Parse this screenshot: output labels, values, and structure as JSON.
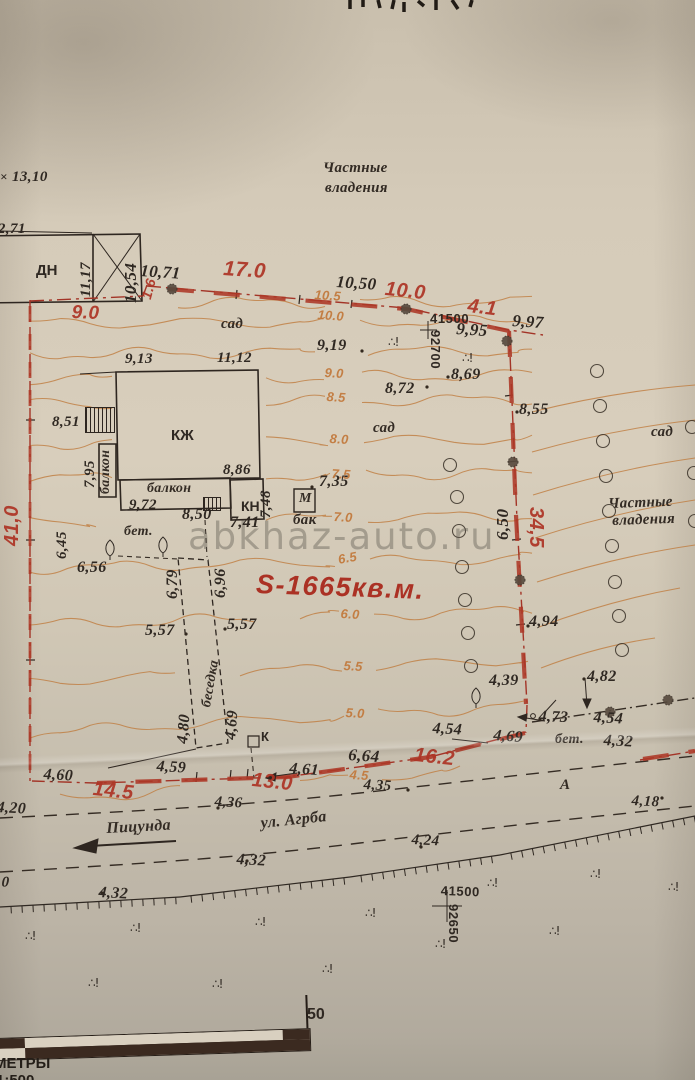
{
  "colors": {
    "paper": "#d5cbb9",
    "ink": "#2f2822",
    "red_boundary": "#a83526",
    "red_label": "#ae3526",
    "contour_orange": "#c07c3e",
    "watermark_gray": "#605a52",
    "scalebar_dark": "#3b2a20"
  },
  "watermark": "abkhaz-auto.ru",
  "plot": {
    "area_label": "S-1665кв.м."
  },
  "scale": {
    "bar_max": "50",
    "units": "МЕТРЫ",
    "ratio": "1:500"
  },
  "street": {
    "name": "ул. Агрба",
    "direction": "Пицунда",
    "section_point": "А"
  },
  "grid_crosses": [
    {
      "x_label": "41500",
      "y_label": "92700"
    },
    {
      "x_label": "41500",
      "y_label": "92650"
    }
  ],
  "labels": [
    {
      "t": "×",
      "x": 0,
      "y": 170,
      "c": "e",
      "s": 13
    },
    {
      "t": "13,10",
      "x": 12,
      "y": 170,
      "c": "e"
    },
    {
      "t": "12,71",
      "x": -10,
      "y": 222,
      "c": "e"
    },
    {
      "t": "ДН",
      "x": 36,
      "y": 263,
      "c": "u",
      "s": 15
    },
    {
      "t": "11,17",
      "x": 79,
      "y": 297,
      "c": "e",
      "r": -90
    },
    {
      "t": "10,54",
      "x": 122,
      "y": 303,
      "c": "e",
      "r": -90,
      "s": 17
    },
    {
      "t": "10,71",
      "x": 141,
      "y": 262,
      "c": "e",
      "r": 4,
      "s": 17
    },
    {
      "t": "10,50",
      "x": 337,
      "y": 273,
      "c": "e",
      "r": 4,
      "s": 17
    },
    {
      "t": "9,95",
      "x": 457,
      "y": 320,
      "c": "e",
      "r": 4,
      "s": 17
    },
    {
      "t": "9,97",
      "x": 513,
      "y": 312,
      "c": "e",
      "r": 4,
      "s": 17
    },
    {
      "t": "9,19",
      "x": 317,
      "y": 338,
      "c": "e",
      "s": 16
    },
    {
      "t": "8,69",
      "x": 451,
      "y": 367,
      "c": "e",
      "s": 16
    },
    {
      "t": "8,72",
      "x": 385,
      "y": 381,
      "c": "e",
      "s": 16
    },
    {
      "t": "8,55",
      "x": 519,
      "y": 402,
      "c": "e",
      "s": 16
    },
    {
      "t": "9,13",
      "x": 125,
      "y": 352,
      "c": "e"
    },
    {
      "t": "11,12",
      "x": 217,
      "y": 351,
      "c": "e"
    },
    {
      "t": "8,51",
      "x": 52,
      "y": 415,
      "c": "e"
    },
    {
      "t": "7,95",
      "x": 83,
      "y": 488,
      "c": "e",
      "r": -90
    },
    {
      "t": "8,86",
      "x": 223,
      "y": 463,
      "c": "e"
    },
    {
      "t": "9,72",
      "x": 129,
      "y": 498,
      "c": "e"
    },
    {
      "t": "8,50",
      "x": 182,
      "y": 507,
      "c": "e",
      "s": 16
    },
    {
      "t": "7,41",
      "x": 230,
      "y": 515,
      "c": "e",
      "s": 16
    },
    {
      "t": "7,48",
      "x": 259,
      "y": 518,
      "c": "e",
      "r": -90,
      "s": 15
    },
    {
      "t": "7,35",
      "x": 319,
      "y": 474,
      "c": "e",
      "s": 16
    },
    {
      "t": "6,45",
      "x": 55,
      "y": 559,
      "c": "e",
      "r": -90
    },
    {
      "t": "6,56",
      "x": 77,
      "y": 560,
      "c": "e",
      "s": 16
    },
    {
      "t": "6,79",
      "x": 165,
      "y": 599,
      "c": "e",
      "r": -90,
      "s": 16
    },
    {
      "t": "6,96",
      "x": 213,
      "y": 598,
      "c": "e",
      "r": -90,
      "s": 16
    },
    {
      "t": "5,57",
      "x": 145,
      "y": 623,
      "c": "e",
      "s": 16
    },
    {
      "t": "5,57",
      "x": 227,
      "y": 617,
      "c": "e",
      "s": 16
    },
    {
      "t": "4,80",
      "x": 175,
      "y": 743,
      "c": "e",
      "r": -85,
      "s": 16
    },
    {
      "t": "4,69",
      "x": 223,
      "y": 739,
      "c": "e",
      "r": -85,
      "s": 16
    },
    {
      "t": "6,50",
      "x": 494,
      "y": 540,
      "c": "e",
      "r": -90,
      "s": 17
    },
    {
      "t": "4,94",
      "x": 529,
      "y": 614,
      "c": "e",
      "s": 16
    },
    {
      "t": "4,39",
      "x": 489,
      "y": 673,
      "c": "e",
      "s": 16
    },
    {
      "t": "4,82",
      "x": 587,
      "y": 669,
      "c": "e",
      "s": 16
    },
    {
      "t": "4,73",
      "x": 539,
      "y": 709,
      "c": "e",
      "s": 16,
      "r": 2
    },
    {
      "t": "4,54",
      "x": 433,
      "y": 721,
      "c": "e",
      "s": 16,
      "r": 3
    },
    {
      "t": "4,54",
      "x": 594,
      "y": 710,
      "c": "e",
      "s": 16,
      "r": 3
    },
    {
      "t": "4,32",
      "x": 604,
      "y": 733,
      "c": "e",
      "s": 16,
      "r": 3
    },
    {
      "t": "4,69",
      "x": 494,
      "y": 728,
      "c": "e",
      "s": 16,
      "r": 4
    },
    {
      "t": "6,64",
      "x": 349,
      "y": 746,
      "c": "e",
      "s": 17,
      "r": 4
    },
    {
      "t": "4,61",
      "x": 290,
      "y": 761,
      "c": "e",
      "s": 16,
      "r": 4
    },
    {
      "t": "4,35",
      "x": 364,
      "y": 778,
      "c": "e",
      "s": 15,
      "r": 3
    },
    {
      "t": "4,36",
      "x": 215,
      "y": 795,
      "c": "e",
      "s": 15,
      "r": 3
    },
    {
      "t": "4,59",
      "x": 157,
      "y": 759,
      "c": "e",
      "s": 16,
      "r": 3
    },
    {
      "t": "4,60",
      "x": 44,
      "y": 767,
      "c": "e",
      "s": 16,
      "r": 3
    },
    {
      "t": "4,20",
      "x": -3,
      "y": 800,
      "c": "e",
      "s": 16,
      "r": 3
    },
    {
      "t": "4,32",
      "x": 237,
      "y": 852,
      "c": "e",
      "s": 16,
      "r": 3
    },
    {
      "t": "4,32",
      "x": 99,
      "y": 885,
      "c": "e",
      "s": 16,
      "r": 3
    },
    {
      "t": "4,24",
      "x": 412,
      "y": 833,
      "c": "e",
      "s": 15,
      "r": 3
    },
    {
      "t": "4,18",
      "x": 632,
      "y": 794,
      "c": "e",
      "s": 15,
      "r": 3
    },
    {
      "t": "10",
      "x": -6,
      "y": 875,
      "c": "e",
      "s": 15,
      "r": 3
    },
    {
      "t": "41500",
      "x": 430,
      "y": 312,
      "c": "g"
    },
    {
      "t": "92700",
      "x": 442,
      "y": 330,
      "c": "g",
      "r": 90
    },
    {
      "t": "41500",
      "x": 441,
      "y": 884,
      "c": "g",
      "r": 2
    },
    {
      "t": "92650",
      "x": 460,
      "y": 904,
      "c": "g",
      "r": 90
    },
    {
      "t": "50",
      "x": 307,
      "y": 1007,
      "c": "u",
      "s": 16
    },
    {
      "t": "17.0",
      "x": 224,
      "y": 258,
      "c": "r",
      "s": 21,
      "r": 4
    },
    {
      "t": "10.0",
      "x": 386,
      "y": 279,
      "c": "r",
      "s": 20,
      "r": 6
    },
    {
      "t": "4.1",
      "x": 469,
      "y": 296,
      "c": "r",
      "s": 20,
      "r": 7
    },
    {
      "t": "1.6",
      "x": 139,
      "y": 297,
      "c": "r",
      "r": -75,
      "s": 14
    },
    {
      "t": "9.0",
      "x": 72,
      "y": 303,
      "c": "r",
      "s": 19,
      "r": 2
    },
    {
      "t": "41,0",
      "x": 2,
      "y": 546,
      "c": "r",
      "r": -90,
      "s": 20
    },
    {
      "t": "34,5",
      "x": 546,
      "y": 507,
      "c": "r",
      "r": 90,
      "s": 20
    },
    {
      "t": "16.2",
      "x": 415,
      "y": 745,
      "c": "r",
      "s": 20,
      "r": 6
    },
    {
      "t": "13.0",
      "x": 253,
      "y": 770,
      "c": "r",
      "s": 20,
      "r": 6
    },
    {
      "t": "14.5",
      "x": 94,
      "y": 779,
      "c": "r",
      "s": 20,
      "r": 6
    },
    {
      "t": "10.5",
      "x": 315,
      "y": 288,
      "c": "o",
      "r": 4
    },
    {
      "t": "10.0",
      "x": 318,
      "y": 308,
      "c": "o",
      "r": 4
    },
    {
      "t": "9.0",
      "x": 325,
      "y": 366,
      "c": "o",
      "r": 3
    },
    {
      "t": "8.5",
      "x": 327,
      "y": 390,
      "c": "o",
      "r": 3
    },
    {
      "t": "8.0",
      "x": 330,
      "y": 432,
      "c": "o",
      "r": 3
    },
    {
      "t": "7.5",
      "x": 332,
      "y": 467,
      "c": "o",
      "r": 3
    },
    {
      "t": "7.0",
      "x": 334,
      "y": 510,
      "c": "o",
      "r": 3
    },
    {
      "t": "6.5",
      "x": 337,
      "y": 553,
      "c": "o",
      "r": -10
    },
    {
      "t": "6.0",
      "x": 341,
      "y": 607,
      "c": "o",
      "r": 3
    },
    {
      "t": "5.5",
      "x": 344,
      "y": 659,
      "c": "o",
      "r": 3
    },
    {
      "t": "5.0",
      "x": 346,
      "y": 706,
      "c": "o",
      "r": 3
    },
    {
      "t": "4.5",
      "x": 350,
      "y": 768,
      "c": "o",
      "r": 3
    },
    {
      "t": "Частные",
      "x": 323,
      "y": 161,
      "c": "p"
    },
    {
      "t": "владения",
      "x": 325,
      "y": 181,
      "c": "p"
    },
    {
      "t": "Частные",
      "x": 608,
      "y": 497,
      "c": "p",
      "r": -2
    },
    {
      "t": "владения",
      "x": 612,
      "y": 514,
      "c": "p",
      "r": -2
    },
    {
      "t": "сад",
      "x": 221,
      "y": 317,
      "c": "p"
    },
    {
      "t": "сад",
      "x": 373,
      "y": 421,
      "c": "p"
    },
    {
      "t": "сад",
      "x": 651,
      "y": 425,
      "c": "p"
    },
    {
      "t": "КЖ",
      "x": 171,
      "y": 428,
      "c": "u",
      "s": 15
    },
    {
      "t": "балкон",
      "x": 99,
      "y": 494,
      "c": "p",
      "r": -90,
      "s": 14
    },
    {
      "t": "балкон",
      "x": 147,
      "y": 482,
      "c": "p",
      "s": 14
    },
    {
      "t": "КН",
      "x": 241,
      "y": 499,
      "c": "u",
      "s": 14
    },
    {
      "t": "М",
      "x": 299,
      "y": 492,
      "c": "p",
      "s": 14
    },
    {
      "t": "бак",
      "x": 293,
      "y": 513,
      "c": "p",
      "s": 15
    },
    {
      "t": "К",
      "x": 261,
      "y": 730,
      "c": "u",
      "s": 13
    },
    {
      "t": "бет.",
      "x": 124,
      "y": 525,
      "c": "p",
      "s": 14
    },
    {
      "t": "бет.",
      "x": 555,
      "y": 733,
      "c": "p",
      "s": 14
    },
    {
      "t": "беседка",
      "x": 200,
      "y": 706,
      "c": "p",
      "r": -80,
      "s": 14
    },
    {
      "t": "Пицунда",
      "x": 106,
      "y": 821,
      "c": "p",
      "s": 16,
      "r": -3
    },
    {
      "t": "ул. Агрба",
      "x": 260,
      "y": 816,
      "c": "p",
      "s": 16,
      "r": -6
    },
    {
      "t": "А",
      "x": 560,
      "y": 778,
      "c": "p",
      "s": 15
    }
  ],
  "symbols": {
    "veg_glyph": "∴!",
    "veg_marks": [
      [
        388,
        336
      ],
      [
        462,
        352
      ],
      [
        25,
        930
      ],
      [
        130,
        922
      ],
      [
        255,
        916
      ],
      [
        88,
        977
      ],
      [
        212,
        978
      ],
      [
        322,
        963
      ],
      [
        365,
        907
      ],
      [
        435,
        938
      ],
      [
        487,
        877
      ],
      [
        590,
        868
      ],
      [
        668,
        881
      ],
      [
        549,
        925
      ]
    ],
    "tree_circles": [
      [
        450,
        465
      ],
      [
        457,
        497
      ],
      [
        459,
        531
      ],
      [
        462,
        567
      ],
      [
        465,
        600
      ],
      [
        468,
        633
      ],
      [
        471,
        666
      ],
      [
        597,
        371
      ],
      [
        600,
        406
      ],
      [
        603,
        441
      ],
      [
        606,
        476
      ],
      [
        609,
        511
      ],
      [
        612,
        546
      ],
      [
        615,
        582
      ],
      [
        619,
        616
      ],
      [
        622,
        650
      ],
      [
        692,
        427
      ],
      [
        694,
        473
      ],
      [
        695,
        521
      ]
    ],
    "cypress_trees": [
      [
        110,
        549
      ],
      [
        163,
        546
      ],
      [
        476,
        697
      ]
    ],
    "survey_points": [
      [
        172,
        289
      ],
      [
        406,
        309
      ],
      [
        507,
        341
      ],
      [
        513,
        462
      ],
      [
        520,
        580
      ],
      [
        610,
        712
      ],
      [
        668,
        700
      ]
    ],
    "dots": [
      [
        312,
        487
      ],
      [
        362,
        351
      ],
      [
        448,
        377
      ],
      [
        517,
        412
      ],
      [
        427,
        387
      ],
      [
        186,
        634
      ],
      [
        225,
        629
      ],
      [
        528,
        626
      ],
      [
        584,
        679
      ],
      [
        540,
        719
      ],
      [
        247,
        861
      ],
      [
        421,
        847
      ],
      [
        662,
        798
      ],
      [
        218,
        808
      ],
      [
        408,
        790
      ],
      [
        102,
        893
      ]
    ]
  }
}
